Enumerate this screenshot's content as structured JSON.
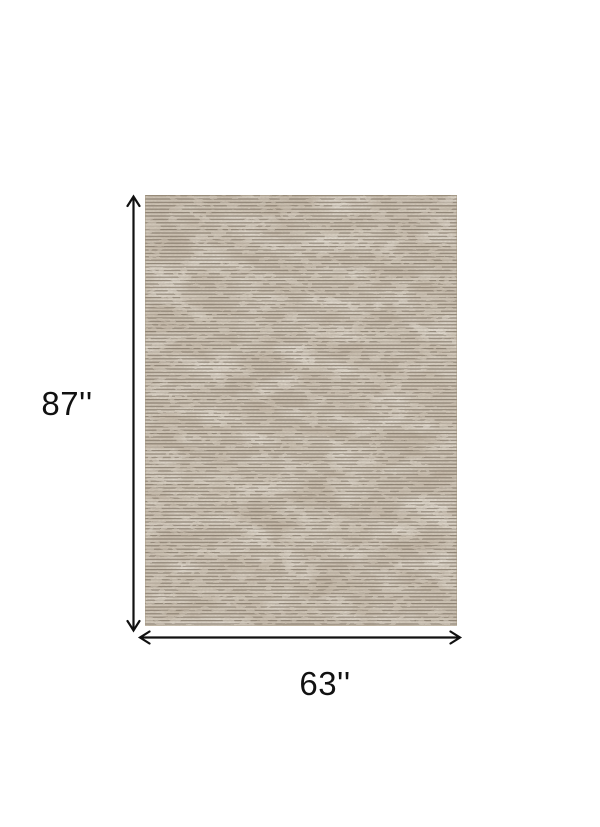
{
  "diagram": {
    "background_color": "#ffffff",
    "dimension_line_color": "#111111",
    "label_color": "#111111",
    "height_label": "87''",
    "width_label": "63''",
    "rug": {
      "base_color": "#d5ccbe",
      "stripe_color": "#6e6253",
      "dark_patch_color": "#83735f",
      "light_patch_color": "#f0ebe1",
      "edge_color": "#a2957f"
    }
  }
}
